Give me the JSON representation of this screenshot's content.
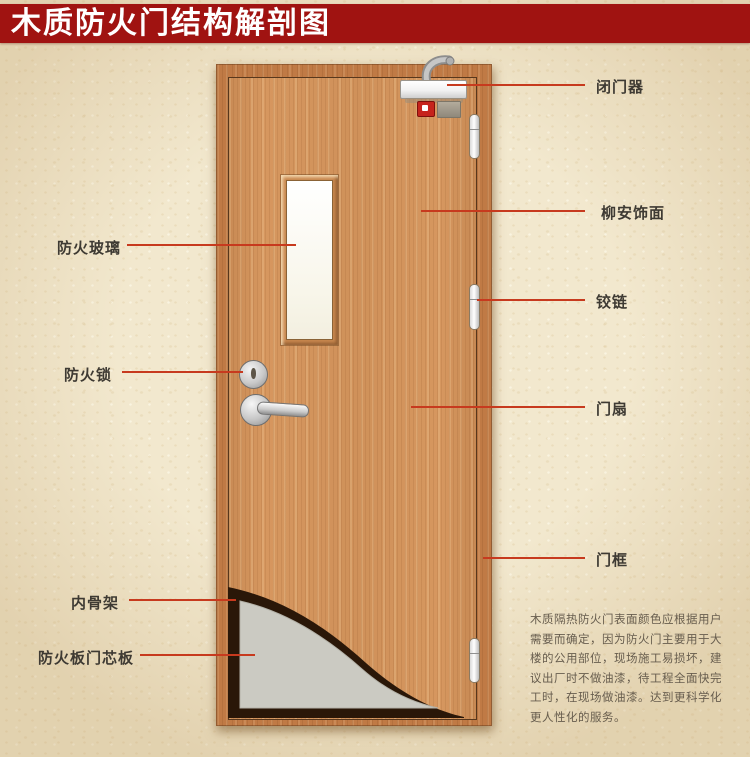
{
  "header": {
    "title": "木质防火门结构解剖图"
  },
  "labels": {
    "door_closer": "闭门器",
    "veneer": "柳安饰面",
    "hinge": "铰链",
    "door_leaf": "门扇",
    "door_frame": "门框",
    "fire_glass": "防火玻璃",
    "fire_lock": "防火锁",
    "inner_frame": "内骨架",
    "core_board": "防火板门芯板"
  },
  "note": {
    "text": "木质隔热防火门表面颜色应根据用户需要而确定，因为防火门主要用于大楼的公用部位，现场施工易损坏，建议出厂时不做油漆，待工程全面快完工时，在现场做油漆。达到更科学化更人性化的服务。"
  },
  "colors": {
    "banner_red": "#a01311",
    "callout_line_red": "#c73a1e",
    "door_frame_wood": "#c07a45",
    "door_leaf_wood": "#d6975f",
    "background_beige": "#f2e8ce",
    "cutaway_dark": "#2a1708",
    "core_gray": "#cbcac2",
    "alarm_red": "#c6231c"
  }
}
